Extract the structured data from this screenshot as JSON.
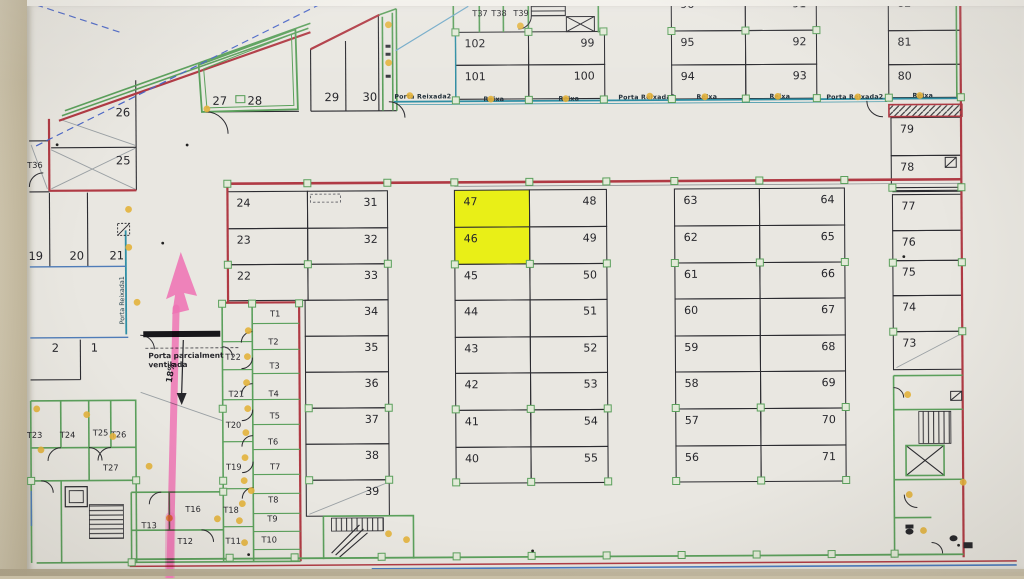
{
  "title": "Parking garage floor plan (photo) with highlighted stalls",
  "colors": {
    "highlight": "#e8f005",
    "annotation_pink": "#ee74b4",
    "wall_red": "#b03a44",
    "wall_green": "#5ba05c",
    "wall_teal": "#2f8fa5",
    "door_dot": "#e3b33c",
    "line_black": "#2b2b30"
  },
  "highlighted_spaces": [
    "47",
    "46"
  ],
  "annotations": {
    "ramp_percent": "18%",
    "vent_note_line1": "Porta parcialment",
    "vent_note_line2": "ventilada",
    "porta_reixada1": "Porta Reixada1"
  },
  "door_labels": [
    {
      "t": "Porta Reixada2",
      "x": 424,
      "y": 98
    },
    {
      "t": "Reixa",
      "x": 495,
      "y": 101
    },
    {
      "t": "Reixa",
      "x": 570,
      "y": 101
    },
    {
      "t": "Porta Reixada2",
      "x": 648,
      "y": 100
    },
    {
      "t": "Reixa",
      "x": 708,
      "y": 100
    },
    {
      "t": "Reixa",
      "x": 781,
      "y": 100
    },
    {
      "t": "Porta Reixada2",
      "x": 856,
      "y": 101
    },
    {
      "t": "Reixa",
      "x": 924,
      "y": 100
    }
  ],
  "area_labels": [
    {
      "n": "26",
      "x": 124,
      "y": 114
    },
    {
      "n": "25",
      "x": 124,
      "y": 162
    },
    {
      "n": "27",
      "x": 221,
      "y": 103
    },
    {
      "n": "28",
      "x": 256,
      "y": 103
    },
    {
      "n": "29",
      "x": 333,
      "y": 100
    },
    {
      "n": "30",
      "x": 371,
      "y": 100
    },
    {
      "n": "19",
      "x": 36,
      "y": 257
    },
    {
      "n": "20",
      "x": 77,
      "y": 257
    },
    {
      "n": "21",
      "x": 117,
      "y": 257
    },
    {
      "n": "2",
      "x": 55,
      "y": 349
    },
    {
      "n": "1",
      "x": 94,
      "y": 349
    }
  ],
  "room_labels": [
    {
      "n": "T36",
      "x": 28,
      "y": 165
    },
    {
      "n": "T37",
      "x": 474,
      "y": 16
    },
    {
      "n": "T38",
      "x": 493,
      "y": 16
    },
    {
      "n": "T39",
      "x": 515,
      "y": 16
    },
    {
      "n": "T1",
      "x": 270,
      "y": 315
    },
    {
      "n": "T2",
      "x": 268,
      "y": 343
    },
    {
      "n": "T3",
      "x": 269,
      "y": 367
    },
    {
      "n": "T4",
      "x": 268,
      "y": 395
    },
    {
      "n": "T5",
      "x": 269,
      "y": 417
    },
    {
      "n": "T6",
      "x": 267,
      "y": 443
    },
    {
      "n": "T7",
      "x": 269,
      "y": 468
    },
    {
      "n": "T8",
      "x": 267,
      "y": 501
    },
    {
      "n": "T9",
      "x": 266,
      "y": 520
    },
    {
      "n": "T10",
      "x": 260,
      "y": 541
    },
    {
      "n": "T11",
      "x": 224,
      "y": 542
    },
    {
      "n": "T12",
      "x": 176,
      "y": 542
    },
    {
      "n": "T13",
      "x": 140,
      "y": 526
    },
    {
      "n": "T16",
      "x": 184,
      "y": 510
    },
    {
      "n": "T18",
      "x": 222,
      "y": 511
    },
    {
      "n": "T19",
      "x": 225,
      "y": 468
    },
    {
      "n": "T20",
      "x": 225,
      "y": 426
    },
    {
      "n": "T21",
      "x": 228,
      "y": 395
    },
    {
      "n": "T22",
      "x": 225,
      "y": 358
    },
    {
      "n": "T23",
      "x": 26,
      "y": 435
    },
    {
      "n": "T24",
      "x": 59,
      "y": 435
    },
    {
      "n": "T25",
      "x": 92,
      "y": 433
    },
    {
      "n": "T26",
      "x": 110,
      "y": 435
    },
    {
      "n": "T27",
      "x": 102,
      "y": 468
    }
  ],
  "parking_spaces": [
    {
      "n": "102",
      "x": 457,
      "y": 32,
      "w": 73,
      "h": 33,
      "a": "l"
    },
    {
      "n": "99",
      "x": 530,
      "y": 32,
      "w": 76,
      "h": 33,
      "a": "r"
    },
    {
      "n": "101",
      "x": 457,
      "y": 65,
      "w": 73,
      "h": 34,
      "a": "l"
    },
    {
      "n": "100",
      "x": 530,
      "y": 65,
      "w": 76,
      "h": 34,
      "a": "r"
    },
    {
      "n": "96",
      "x": 673,
      "y": -6,
      "w": 74,
      "h": 38,
      "a": "l"
    },
    {
      "n": "91",
      "x": 747,
      "y": -6,
      "w": 71,
      "h": 38,
      "a": "r"
    },
    {
      "n": "95",
      "x": 673,
      "y": 32,
      "w": 74,
      "h": 34,
      "a": "l"
    },
    {
      "n": "92",
      "x": 747,
      "y": 32,
      "w": 71,
      "h": 34,
      "a": "r"
    },
    {
      "n": "94",
      "x": 673,
      "y": 66,
      "w": 74,
      "h": 34,
      "a": "l"
    },
    {
      "n": "93",
      "x": 747,
      "y": 66,
      "w": 71,
      "h": 34,
      "a": "r"
    },
    {
      "n": "82",
      "x": 890,
      "y": -6,
      "w": 72,
      "h": 39,
      "a": "l"
    },
    {
      "n": "81",
      "x": 890,
      "y": 33,
      "w": 72,
      "h": 34,
      "a": "l"
    },
    {
      "n": "80",
      "x": 890,
      "y": 67,
      "w": 72,
      "h": 33,
      "a": "l"
    },
    {
      "n": "79",
      "x": 892,
      "y": 120,
      "w": 70,
      "h": 38,
      "a": "l"
    },
    {
      "n": "78",
      "x": 892,
      "y": 158,
      "w": 70,
      "h": 35,
      "a": "l"
    },
    {
      "n": "77",
      "x": 893,
      "y": 197,
      "w": 69,
      "h": 36,
      "a": "l"
    },
    {
      "n": "76",
      "x": 893,
      "y": 233,
      "w": 69,
      "h": 30,
      "a": "l"
    },
    {
      "n": "75",
      "x": 893,
      "y": 263,
      "w": 69,
      "h": 35,
      "a": "l"
    },
    {
      "n": "74",
      "x": 893,
      "y": 298,
      "w": 69,
      "h": 36,
      "a": "l"
    },
    {
      "n": "73",
      "x": 893,
      "y": 334,
      "w": 69,
      "h": 38,
      "a": "l",
      "dg": true
    },
    {
      "n": "24",
      "x": 228,
      "y": 190,
      "w": 80,
      "h": 37,
      "a": "l"
    },
    {
      "n": "31",
      "x": 308,
      "y": 190,
      "w": 80,
      "h": 37,
      "a": "r"
    },
    {
      "n": "23",
      "x": 228,
      "y": 227,
      "w": 80,
      "h": 36,
      "a": "l"
    },
    {
      "n": "32",
      "x": 308,
      "y": 227,
      "w": 80,
      "h": 36,
      "a": "r"
    },
    {
      "n": "22",
      "x": 228,
      "y": 263,
      "w": 80,
      "h": 36,
      "a": "l"
    },
    {
      "n": "33",
      "x": 308,
      "y": 263,
      "w": 80,
      "h": 36,
      "a": "r"
    },
    {
      "n": "34",
      "x": 305,
      "y": 299,
      "w": 83,
      "h": 36,
      "a": "r"
    },
    {
      "n": "35",
      "x": 305,
      "y": 335,
      "w": 83,
      "h": 36,
      "a": "r"
    },
    {
      "n": "36",
      "x": 305,
      "y": 371,
      "w": 83,
      "h": 36,
      "a": "r"
    },
    {
      "n": "37",
      "x": 305,
      "y": 407,
      "w": 83,
      "h": 36,
      "a": "r"
    },
    {
      "n": "38",
      "x": 305,
      "y": 443,
      "w": 83,
      "h": 36,
      "a": "r"
    },
    {
      "n": "39",
      "x": 305,
      "y": 479,
      "w": 83,
      "h": 36,
      "a": "r",
      "dg": true
    },
    {
      "n": "47",
      "x": 455,
      "y": 190,
      "w": 75,
      "h": 37,
      "a": "l",
      "hl": true
    },
    {
      "n": "48",
      "x": 530,
      "y": 190,
      "w": 77,
      "h": 37,
      "a": "r"
    },
    {
      "n": "46",
      "x": 455,
      "y": 227,
      "w": 75,
      "h": 37,
      "a": "l",
      "hl": true
    },
    {
      "n": "49",
      "x": 530,
      "y": 227,
      "w": 77,
      "h": 37,
      "a": "r"
    },
    {
      "n": "45",
      "x": 455,
      "y": 264,
      "w": 75,
      "h": 36,
      "a": "l"
    },
    {
      "n": "50",
      "x": 530,
      "y": 264,
      "w": 77,
      "h": 36,
      "a": "r"
    },
    {
      "n": "44",
      "x": 455,
      "y": 300,
      "w": 75,
      "h": 37,
      "a": "l"
    },
    {
      "n": "51",
      "x": 530,
      "y": 300,
      "w": 77,
      "h": 37,
      "a": "r"
    },
    {
      "n": "43",
      "x": 455,
      "y": 337,
      "w": 75,
      "h": 36,
      "a": "l"
    },
    {
      "n": "52",
      "x": 530,
      "y": 337,
      "w": 77,
      "h": 36,
      "a": "r"
    },
    {
      "n": "42",
      "x": 455,
      "y": 373,
      "w": 75,
      "h": 37,
      "a": "l"
    },
    {
      "n": "53",
      "x": 530,
      "y": 373,
      "w": 77,
      "h": 37,
      "a": "r"
    },
    {
      "n": "41",
      "x": 455,
      "y": 410,
      "w": 75,
      "h": 37,
      "a": "l"
    },
    {
      "n": "54",
      "x": 530,
      "y": 410,
      "w": 77,
      "h": 37,
      "a": "r"
    },
    {
      "n": "40",
      "x": 455,
      "y": 447,
      "w": 75,
      "h": 36,
      "a": "l"
    },
    {
      "n": "55",
      "x": 530,
      "y": 447,
      "w": 77,
      "h": 36,
      "a": "r"
    },
    {
      "n": "63",
      "x": 675,
      "y": 190,
      "w": 85,
      "h": 37,
      "a": "l"
    },
    {
      "n": "64",
      "x": 760,
      "y": 190,
      "w": 85,
      "h": 37,
      "a": "r"
    },
    {
      "n": "62",
      "x": 675,
      "y": 227,
      "w": 85,
      "h": 37,
      "a": "l"
    },
    {
      "n": "65",
      "x": 760,
      "y": 227,
      "w": 85,
      "h": 37,
      "a": "r"
    },
    {
      "n": "61",
      "x": 675,
      "y": 264,
      "w": 85,
      "h": 36,
      "a": "l"
    },
    {
      "n": "66",
      "x": 760,
      "y": 264,
      "w": 85,
      "h": 36,
      "a": "r"
    },
    {
      "n": "60",
      "x": 675,
      "y": 300,
      "w": 85,
      "h": 37,
      "a": "l"
    },
    {
      "n": "67",
      "x": 760,
      "y": 300,
      "w": 85,
      "h": 37,
      "a": "r"
    },
    {
      "n": "59",
      "x": 675,
      "y": 337,
      "w": 85,
      "h": 36,
      "a": "l"
    },
    {
      "n": "68",
      "x": 760,
      "y": 337,
      "w": 85,
      "h": 36,
      "a": "r"
    },
    {
      "n": "58",
      "x": 675,
      "y": 373,
      "w": 85,
      "h": 37,
      "a": "l"
    },
    {
      "n": "69",
      "x": 760,
      "y": 373,
      "w": 85,
      "h": 37,
      "a": "r"
    },
    {
      "n": "57",
      "x": 675,
      "y": 410,
      "w": 85,
      "h": 37,
      "a": "l"
    },
    {
      "n": "70",
      "x": 760,
      "y": 410,
      "w": 85,
      "h": 37,
      "a": "r"
    },
    {
      "n": "56",
      "x": 675,
      "y": 447,
      "w": 85,
      "h": 36,
      "a": "l"
    },
    {
      "n": "71",
      "x": 760,
      "y": 447,
      "w": 85,
      "h": 36,
      "a": "r"
    }
  ],
  "column_markers": [
    [
      228,
      182
    ],
    [
      308,
      182
    ],
    [
      388,
      182
    ],
    [
      455,
      182
    ],
    [
      530,
      182
    ],
    [
      607,
      182
    ],
    [
      675,
      182
    ],
    [
      760,
      182
    ],
    [
      845,
      182
    ],
    [
      228,
      263
    ],
    [
      308,
      263
    ],
    [
      388,
      263
    ],
    [
      455,
      264
    ],
    [
      530,
      264
    ],
    [
      607,
      264
    ],
    [
      675,
      264
    ],
    [
      760,
      264
    ],
    [
      845,
      264
    ],
    [
      222,
      407
    ],
    [
      308,
      407
    ],
    [
      388,
      407
    ],
    [
      455,
      409
    ],
    [
      530,
      409
    ],
    [
      607,
      409
    ],
    [
      675,
      409
    ],
    [
      760,
      409
    ],
    [
      845,
      409
    ],
    [
      222,
      479
    ],
    [
      308,
      479
    ],
    [
      388,
      479
    ],
    [
      455,
      482
    ],
    [
      530,
      482
    ],
    [
      607,
      482
    ],
    [
      675,
      482
    ],
    [
      760,
      482
    ],
    [
      845,
      482
    ],
    [
      893,
      190
    ],
    [
      962,
      190
    ],
    [
      893,
      265
    ],
    [
      962,
      265
    ],
    [
      893,
      334
    ],
    [
      962,
      334
    ],
    [
      457,
      100
    ],
    [
      530,
      100
    ],
    [
      605,
      100
    ],
    [
      673,
      100
    ],
    [
      747,
      100
    ],
    [
      818,
      100
    ],
    [
      890,
      100
    ],
    [
      962,
      100
    ],
    [
      457,
      32
    ],
    [
      530,
      32
    ],
    [
      605,
      32
    ],
    [
      673,
      32
    ],
    [
      747,
      32
    ],
    [
      818,
      32
    ],
    [
      228,
      556
    ],
    [
      293,
      556
    ],
    [
      380,
      556
    ],
    [
      455,
      556
    ],
    [
      530,
      556
    ],
    [
      605,
      556
    ],
    [
      680,
      556
    ],
    [
      755,
      556
    ],
    [
      830,
      556
    ],
    [
      893,
      556
    ],
    [
      135,
      478
    ],
    [
      30,
      478
    ],
    [
      222,
      490
    ],
    [
      130,
      560
    ],
    [
      222,
      302
    ],
    [
      299,
      302
    ],
    [
      252,
      302
    ]
  ],
  "door_markers": [
    [
      411,
      95
    ],
    [
      492,
      99
    ],
    [
      567,
      99
    ],
    [
      651,
      97
    ],
    [
      706,
      98
    ],
    [
      779,
      98
    ],
    [
      859,
      99
    ],
    [
      921,
      98
    ],
    [
      390,
      24
    ],
    [
      390,
      62
    ],
    [
      208,
      107
    ],
    [
      522,
      26
    ],
    [
      129,
      207
    ],
    [
      129,
      245
    ],
    [
      137,
      300
    ],
    [
      248,
      329
    ],
    [
      247,
      355
    ],
    [
      246,
      381
    ],
    [
      247,
      407
    ],
    [
      245,
      431
    ],
    [
      244,
      456
    ],
    [
      243,
      479
    ],
    [
      241,
      502
    ],
    [
      238,
      519
    ],
    [
      216,
      517
    ],
    [
      243,
      541
    ],
    [
      168,
      516
    ],
    [
      36,
      406
    ],
    [
      86,
      412
    ],
    [
      112,
      434
    ],
    [
      40,
      447
    ],
    [
      148,
      464
    ],
    [
      250,
      489
    ],
    [
      387,
      533
    ],
    [
      405,
      539
    ],
    [
      907,
      397
    ],
    [
      908,
      497
    ],
    [
      922,
      533
    ],
    [
      962,
      485
    ]
  ],
  "small_black_dots": [
    [
      188,
      143
    ],
    [
      58,
      142
    ],
    [
      531,
      551
    ],
    [
      957,
      548
    ],
    [
      247,
      553
    ],
    [
      904,
      259
    ],
    [
      163,
      241
    ]
  ]
}
